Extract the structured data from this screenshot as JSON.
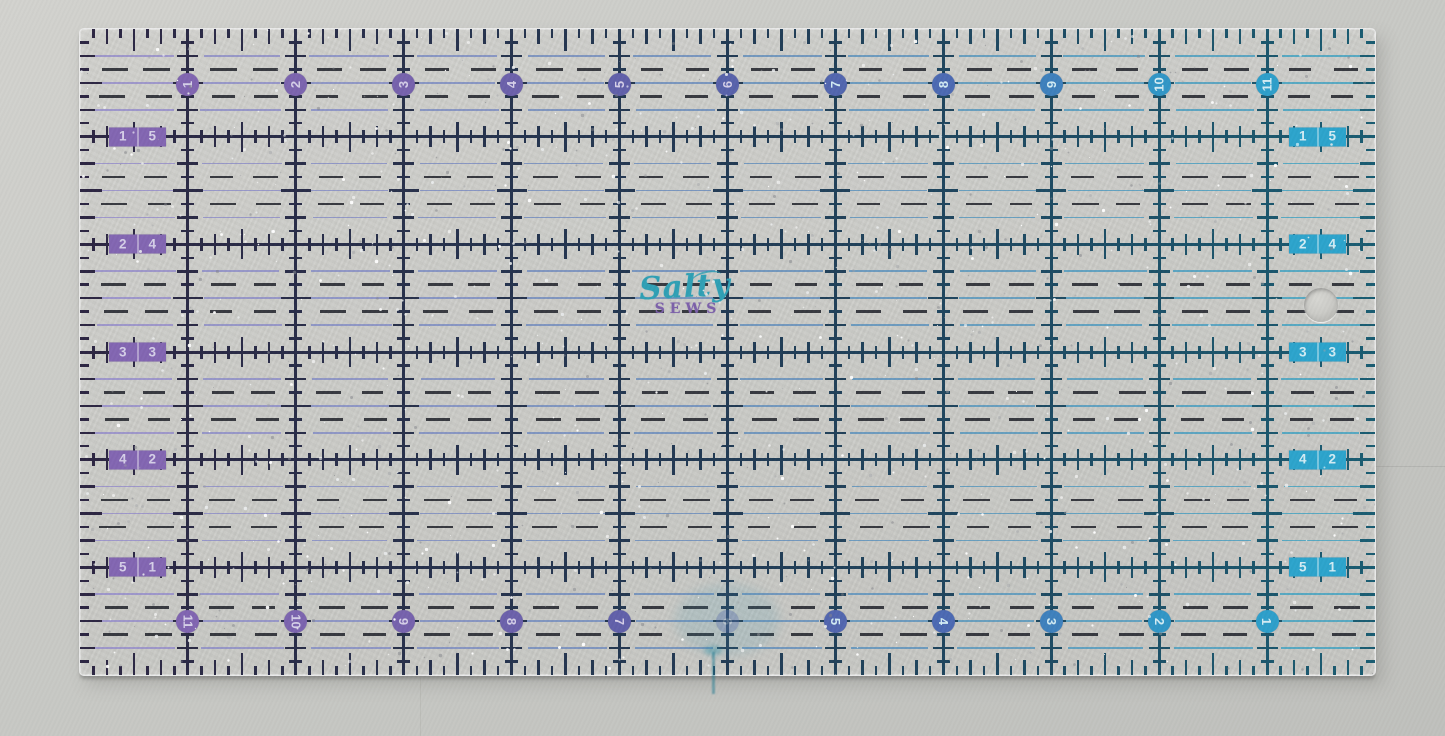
{
  "scene": {
    "background_top": "#d2d2ce",
    "background_bottom": "#bfc0bc"
  },
  "ruler": {
    "geometry": {
      "x": 79,
      "y": 28,
      "width": 1295,
      "height": 646,
      "inches_wide": 12,
      "inches_tall": 6
    },
    "top_numbers": [
      "1",
      "2",
      "3",
      "4",
      "5",
      "6",
      "7",
      "8",
      "9",
      "10",
      "11"
    ],
    "bottom_numbers": [
      "11",
      "10",
      "9",
      "8",
      "7",
      "6",
      "5",
      "4",
      "3",
      "2",
      "1"
    ],
    "bottom_faded_value": "6",
    "left_labels": [
      [
        "1",
        "5"
      ],
      [
        "2",
        "4"
      ],
      [
        "3",
        "3"
      ],
      [
        "4",
        "2"
      ],
      [
        "5",
        "1"
      ]
    ],
    "right_labels": [
      [
        "1",
        "5"
      ],
      [
        "2",
        "4"
      ],
      [
        "3",
        "3"
      ],
      [
        "4",
        "2"
      ],
      [
        "5",
        "1"
      ]
    ],
    "logo": {
      "line1": "Salty",
      "line2": "SEWS",
      "line1_color": "#2d9fb4",
      "line2_color": "#7b5fa9"
    },
    "colors": {
      "circle_gradient": [
        [
          0,
          "#8465b2"
        ],
        [
          0.25,
          "#7560ac"
        ],
        [
          0.45,
          "#5a5ea8"
        ],
        [
          0.67,
          "#4a68b2"
        ],
        [
          0.82,
          "#2f93c5"
        ],
        [
          1,
          "#28a8ce"
        ]
      ],
      "grid_gradient": [
        [
          0,
          "#2a2340"
        ],
        [
          0.5,
          "#1f3852"
        ],
        [
          1,
          "#175a70"
        ]
      ],
      "thinline_gradient": [
        [
          0,
          "#9c90cc"
        ],
        [
          0.5,
          "#6b8fba"
        ],
        [
          1,
          "#46a6c2"
        ]
      ],
      "dash_black": "#20222a",
      "digit_purple_side": "#d5cfe8",
      "digit_teal_side": "#d2ecf4",
      "label_divider": "rgba(255,255,255,0.38)"
    }
  }
}
